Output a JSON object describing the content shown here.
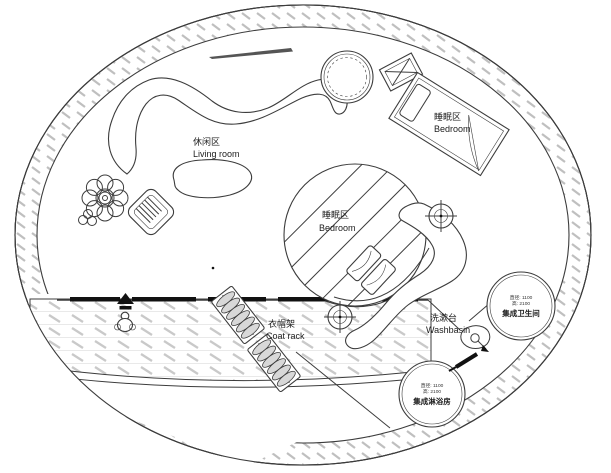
{
  "labels": {
    "living": {
      "zh": "休闲区",
      "en": "Living room"
    },
    "bedroom_main": {
      "zh": "睡眠区",
      "en": "Bedroom"
    },
    "bedroom_center": {
      "zh": "睡眠区",
      "en": "Bedroom"
    },
    "coat_rack": {
      "zh": "衣帽架",
      "en": "Coat rack"
    },
    "washbasin": {
      "zh": "洗漱台",
      "en": "Washbasin"
    },
    "bathroom_pod": {
      "dim_diameter": "直径: 1100",
      "dim_height": "高: 2100",
      "name": "集成卫生间"
    },
    "shower_pod": {
      "dim_diameter": "直径: 1100",
      "dim_height": "高: 2100",
      "name": "集成淋浴房"
    }
  },
  "colors": {
    "line": "#3c3c3c",
    "ink": "#111111",
    "bg": "#ffffff",
    "hatch_ring": "#bfbfbf",
    "hatch_deck": "#c9c9c9",
    "hatch_row": "#e2e2e2"
  }
}
